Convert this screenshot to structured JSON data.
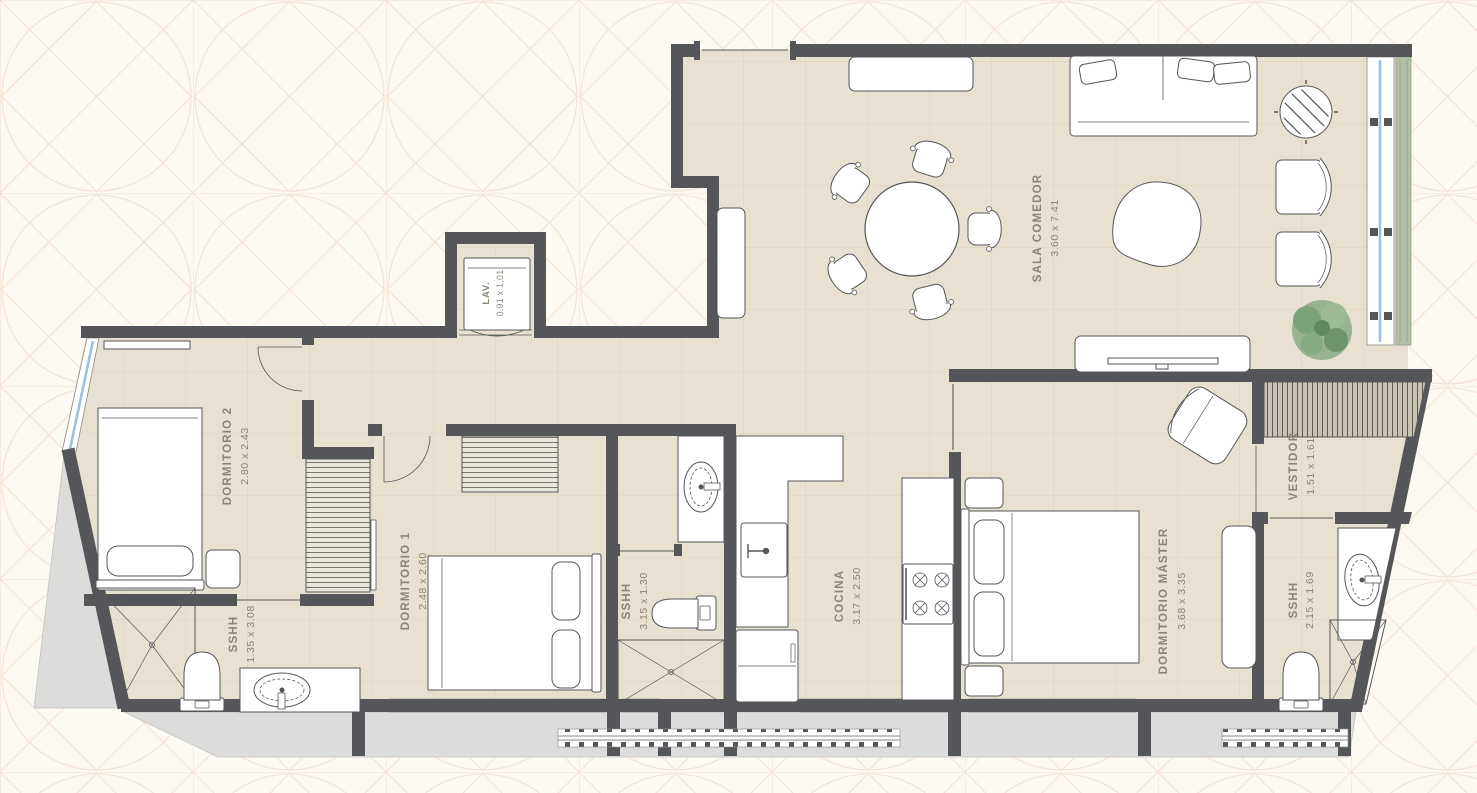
{
  "page": {
    "background_color": "#fdfaf3",
    "pattern_color": "#f5e3d8"
  },
  "floorplan": {
    "colors": {
      "wall": "#55565a",
      "floor": "#e8e1d1",
      "floor_grid": "#ddd3bf",
      "glass": "#9cc0e4",
      "exterior": "#dcdcdb",
      "planter": "#b3bfa7",
      "plant": "#7fa37c",
      "label": "#8b8475"
    },
    "rooms": [
      {
        "label": "DORMITORIO 2",
        "dims": "2.80 x 2.43"
      },
      {
        "label": "DORMITORIO 1",
        "dims": "2.48 x 2.60"
      },
      {
        "label": "SSHH",
        "dims": "1.35 x 3.08"
      },
      {
        "label": "SSHH",
        "dims": "3.15 x 1.30"
      },
      {
        "label": "LAV.",
        "dims": "0.91 x 1.01"
      },
      {
        "label": "COCINA",
        "dims": "3.17 x 2.50"
      },
      {
        "label": "SALA COMEDOR",
        "dims": "3.60 x 7.41"
      },
      {
        "label": "DORMITORIO MÁSTER",
        "dims": "3.68 x 3.35"
      },
      {
        "label": "VESTIDOR",
        "dims": "1.51 x 1.61"
      },
      {
        "label": "SSHH",
        "dims": "2.15 x 1.69"
      }
    ]
  }
}
